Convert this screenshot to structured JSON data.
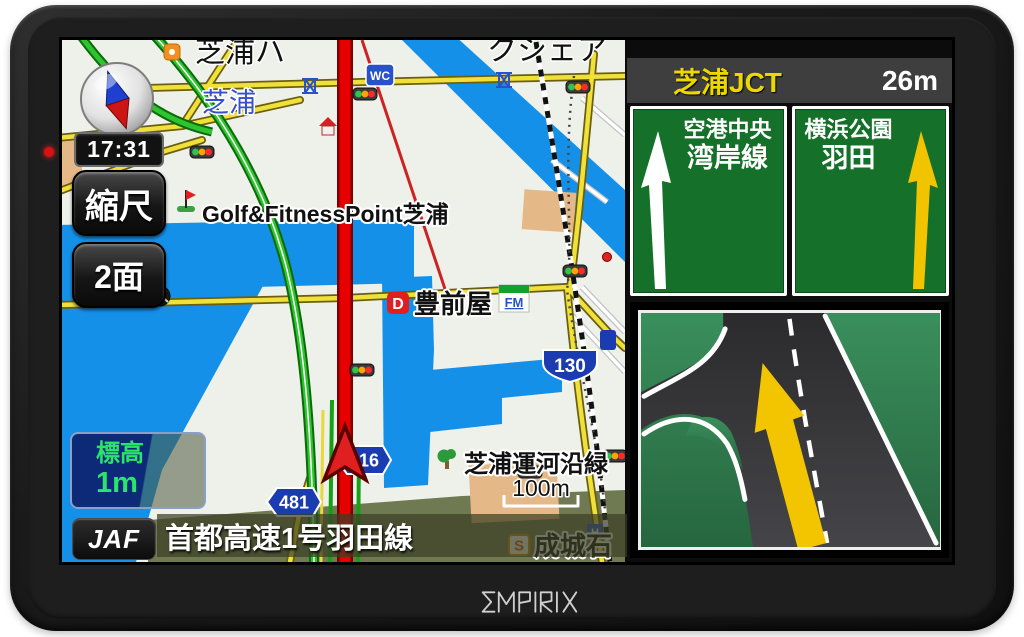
{
  "device": {
    "brand_logo": "EMPIRIX"
  },
  "colors": {
    "route_red": "#e60000",
    "water_blue": "#1590e8",
    "road_yellow": "#f0e13a",
    "sign_green": "#15702a",
    "arrow_yellow": "#f2c400",
    "jct_name_yellow": "#ecd800",
    "elevation_green": "#2be56b"
  },
  "hud": {
    "time": "17:31",
    "scale_button": "縮尺",
    "two_screen_button": "2面",
    "elevation_label": "標高",
    "elevation_value": "1m",
    "jaf_button": "JAF",
    "current_road": "首都高速1号羽田線",
    "map_scale": "100m"
  },
  "junction": {
    "name": "芝浦JCT",
    "distance": "26m"
  },
  "lane_signs": [
    {
      "line1": "空港中央",
      "line2": "湾岸線",
      "arrow_color": "white"
    },
    {
      "line1": "横浜公園",
      "line2": "羽田",
      "arrow_color": "yellow"
    }
  ],
  "map_labels": {
    "area_name": "芝浦",
    "top_street_left": "芝浦ハ",
    "top_street_right": "クシェア",
    "poi_golf": "Golf&FitnessPoint芝浦",
    "poi_shop": "豊前屋",
    "poi_canal": "芝浦運河沿緑",
    "poi_seijo": "成城石",
    "icon_wc": "WC",
    "icon_fm": "FM",
    "icon_d": "D",
    "icon_s": "S",
    "icon_h": "H"
  },
  "route_shields": {
    "r316": "316",
    "r481": "481",
    "r130": "130"
  }
}
